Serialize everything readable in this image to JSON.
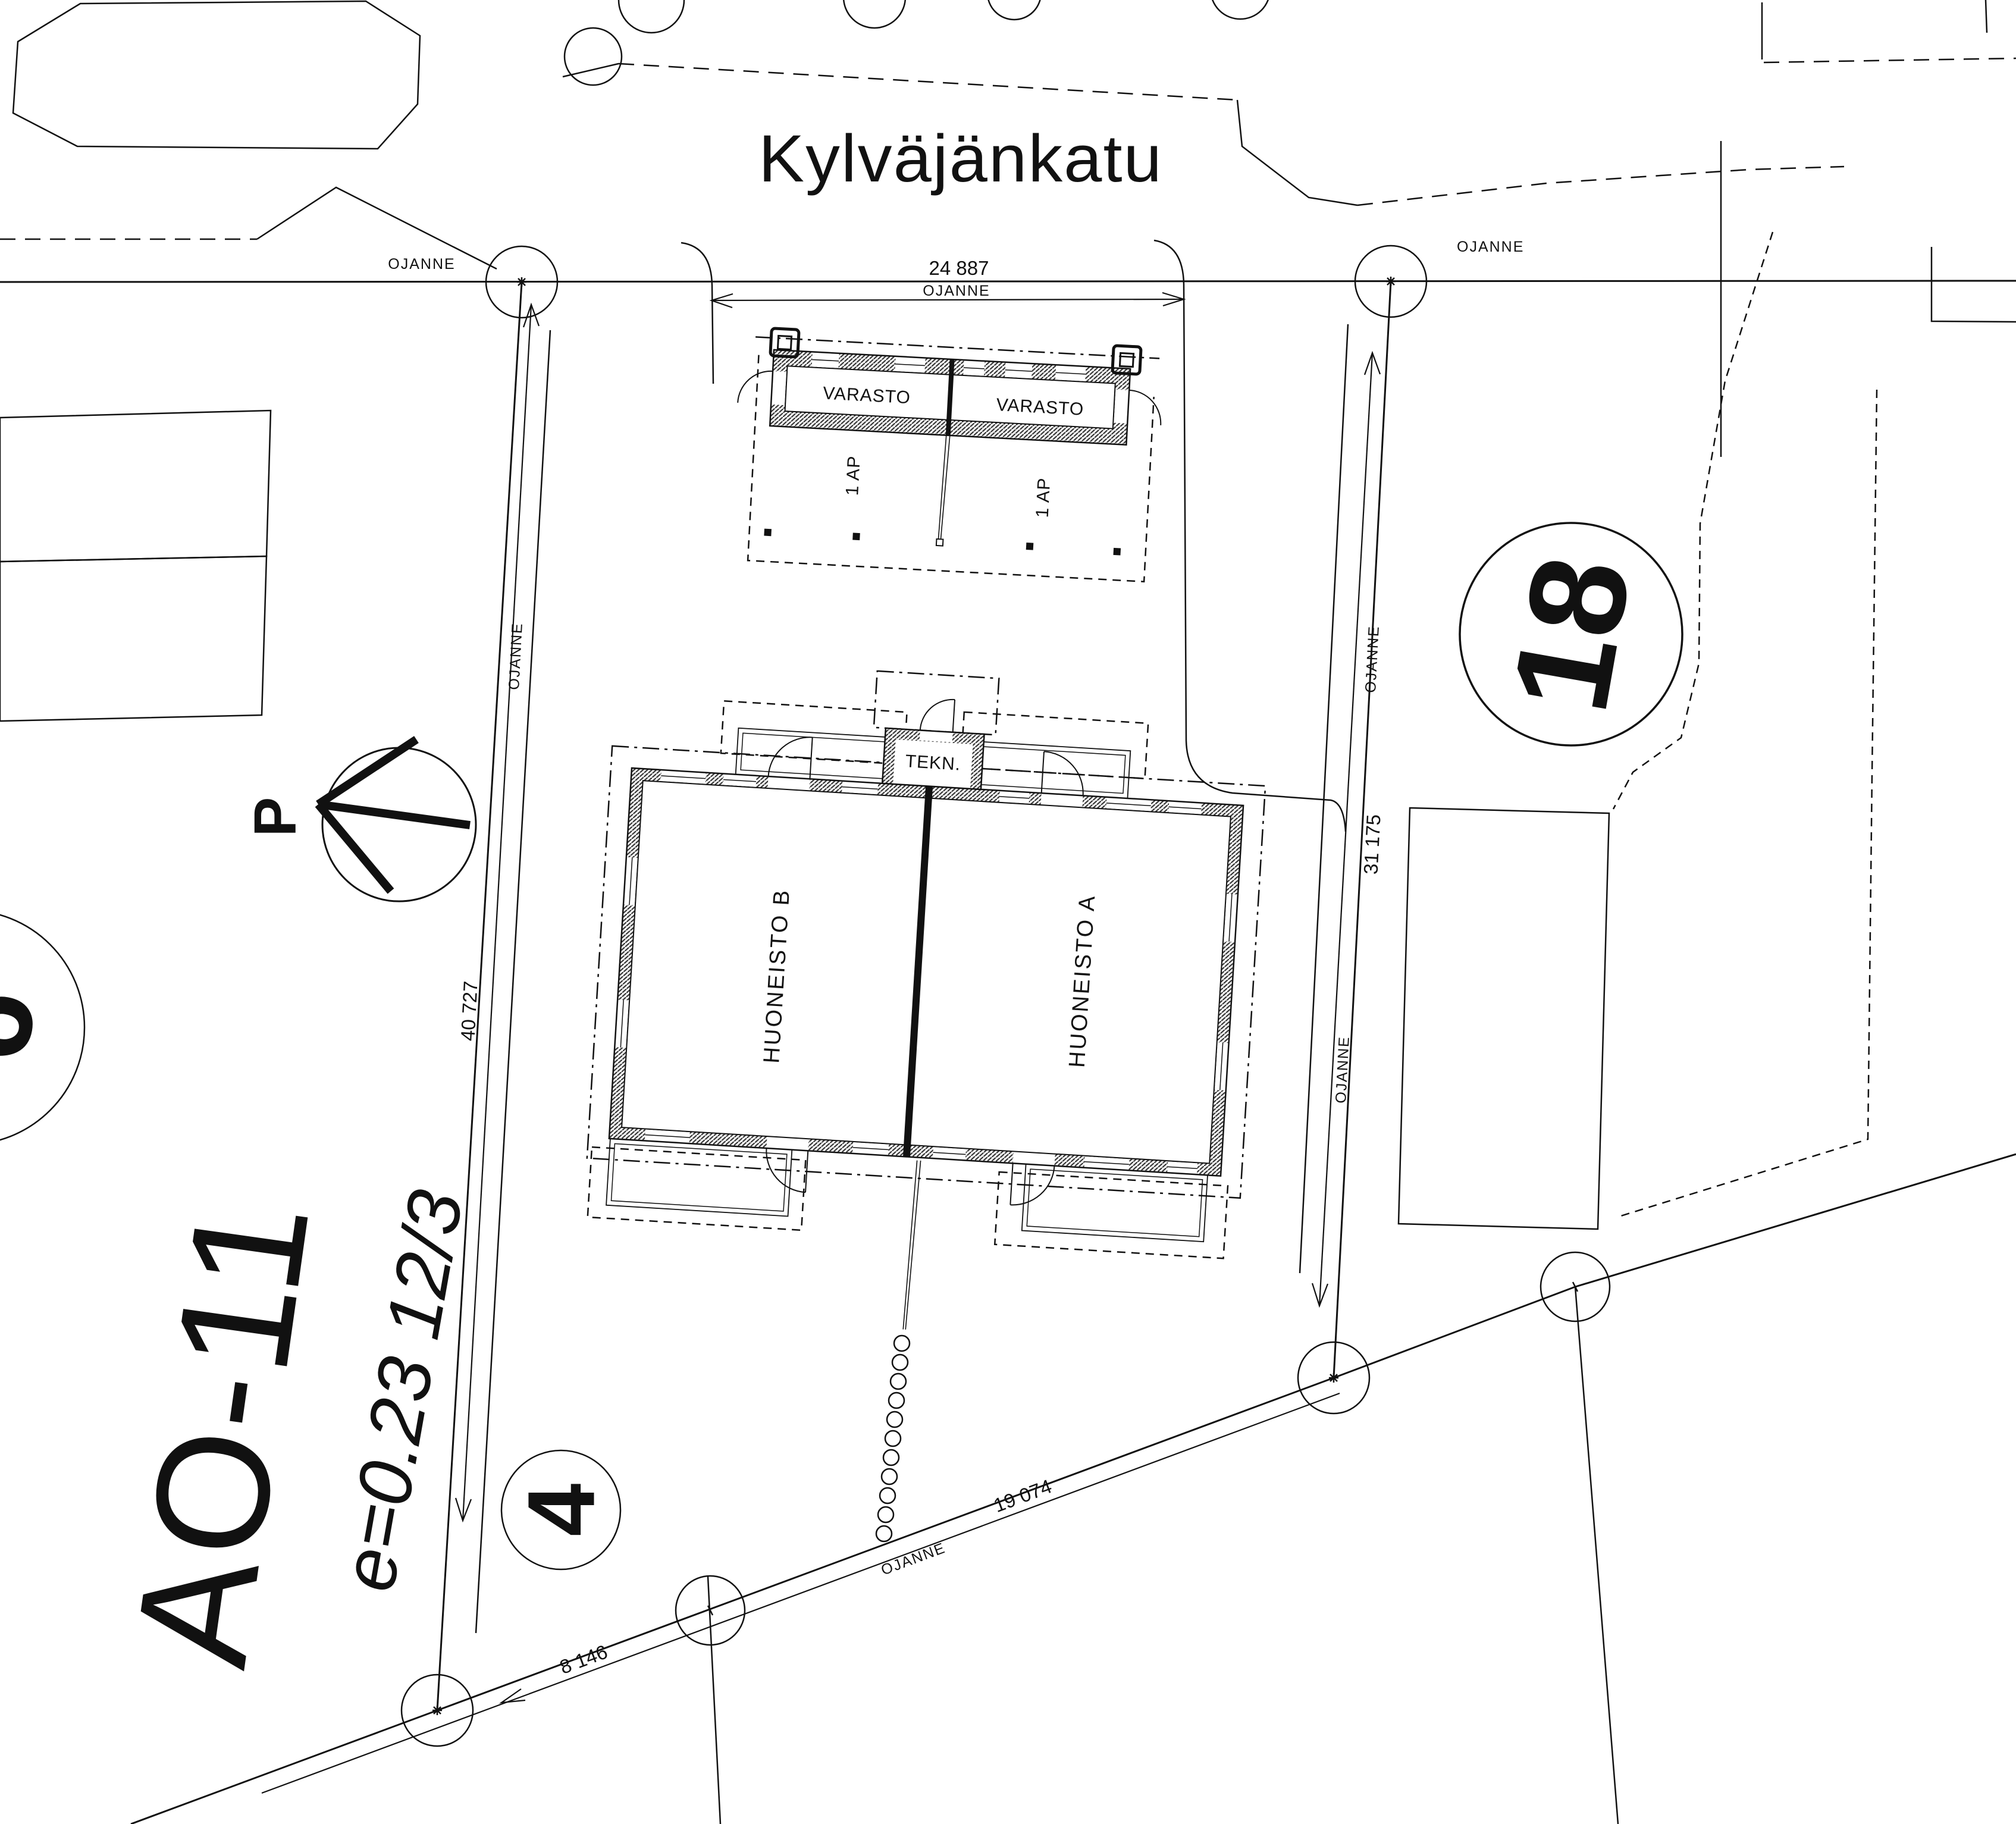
{
  "street": {
    "name": "Kylväjänkatu"
  },
  "plot": {
    "zone_code": "AO-11",
    "efficiency": "e=0.23  12/3",
    "block_number": "18",
    "plot_number": "4",
    "adjacent_plot_number": "6",
    "north_letter": "P"
  },
  "buildings": {
    "storage_left": "VARASTO",
    "storage_right": "VARASTO",
    "parking_left": "1 AP",
    "parking_right": "1 AP",
    "technical_room": "TEKN.",
    "apartment_b": "HUONEISTO B",
    "apartment_a": "HUONEISTO A"
  },
  "dimensions": {
    "street_front": "24 887",
    "west_side": "40 727",
    "east_side": "31 175",
    "south_side_short": "8 146",
    "south_side_long": "19 074"
  },
  "boundary": {
    "ditch_label": "OJANNE"
  },
  "colors": {
    "ink": "#111111",
    "paper": "#ffffff"
  }
}
